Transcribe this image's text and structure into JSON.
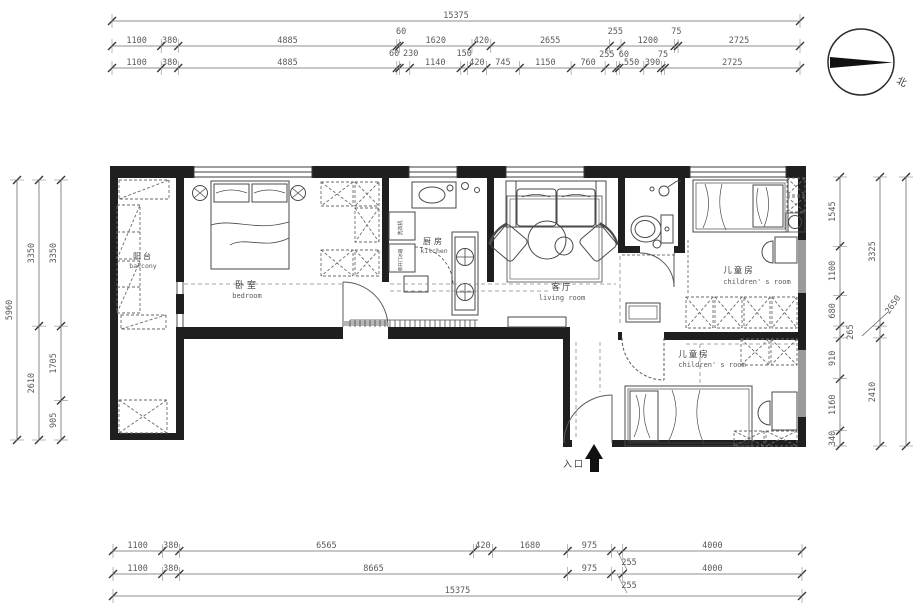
{
  "compass": {
    "north_label": "北"
  },
  "dims": {
    "top_total": "15375",
    "top_row1": [
      "1100",
      "380",
      "4885",
      "60",
      "1620",
      "420",
      "2655",
      "255",
      "1200",
      "75",
      "2725"
    ],
    "top_row2": [
      "1100",
      "380",
      "4885",
      "60",
      "230",
      "1140",
      "150",
      "420",
      "745",
      "1150",
      "760",
      "255",
      "60",
      "550",
      "390",
      "75",
      "2725"
    ],
    "left_total": "5960",
    "left_mid": [
      "3350",
      "2610"
    ],
    "left_inner": [
      "3350",
      "1705",
      "905"
    ],
    "right_inner": [
      "1545",
      "1100",
      "680",
      "265",
      "910",
      "1160",
      "340"
    ],
    "right_mid": [
      "3325",
      "2410"
    ],
    "right_outer_leader": "2650",
    "bottom_row1": [
      "1100",
      "380",
      "6565",
      "420",
      "1680",
      "975",
      "255",
      "4000"
    ],
    "bottom_row2": [
      "1100",
      "380",
      "8665",
      "975",
      "255",
      "4000"
    ],
    "bottom_total": "15375"
  },
  "rooms": {
    "balcony": {
      "zh": "阳台",
      "en": "balcony"
    },
    "bedroom": {
      "zh": "卧室",
      "en": "bedroom"
    },
    "kitchen": {
      "zh": "厨房",
      "en": "kitchen"
    },
    "living": {
      "zh": "客厅",
      "en": "living room"
    },
    "children_top": {
      "zh": "儿童房",
      "en": "children' s room"
    },
    "children_bottom": {
      "zh": "儿童房",
      "en": "children' s room"
    },
    "entrance": {
      "zh": "入口"
    }
  },
  "appliances": {
    "washer": "洗衣机",
    "fridge": "单开门冰箱"
  },
  "colors": {
    "wall": "#1f1f1f",
    "line": "#4a4a4a",
    "dash": "#8a8a8a",
    "text": "#5a5a5a"
  }
}
